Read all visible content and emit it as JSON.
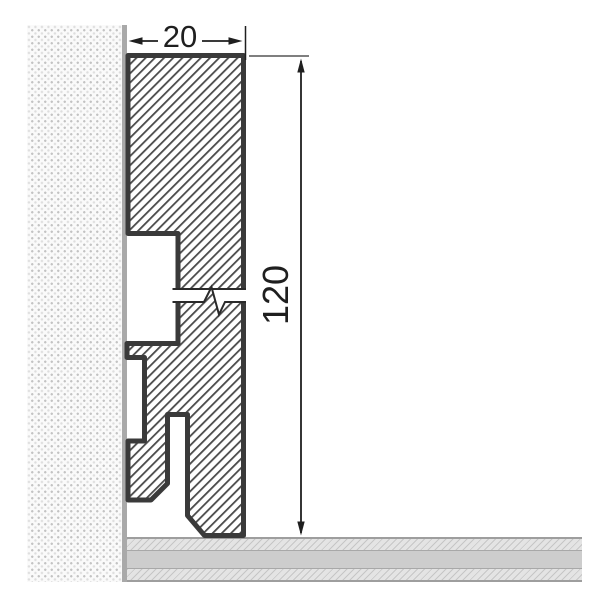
{
  "drawing": {
    "subject": "skirting board profile cross-section",
    "dimensions": {
      "width_label": "20",
      "height_label": "120"
    },
    "symbols": {
      "break_symbol": "zigzag section break",
      "hatch": "diagonal section hatching"
    },
    "colors": {
      "profile_outline": "#3a3a3a",
      "hatch_line": "#4a4a4a",
      "dimension_line": "#1f1f1f",
      "wall_background": "#fafafa",
      "wall_dot": "#c3c3c3",
      "wall_edge": "#a9a9a9",
      "floor_plain_band": "#cdcdcd",
      "floor_hatched_band": "#e4e4e4",
      "floor_border": "#9e9e9e"
    }
  }
}
